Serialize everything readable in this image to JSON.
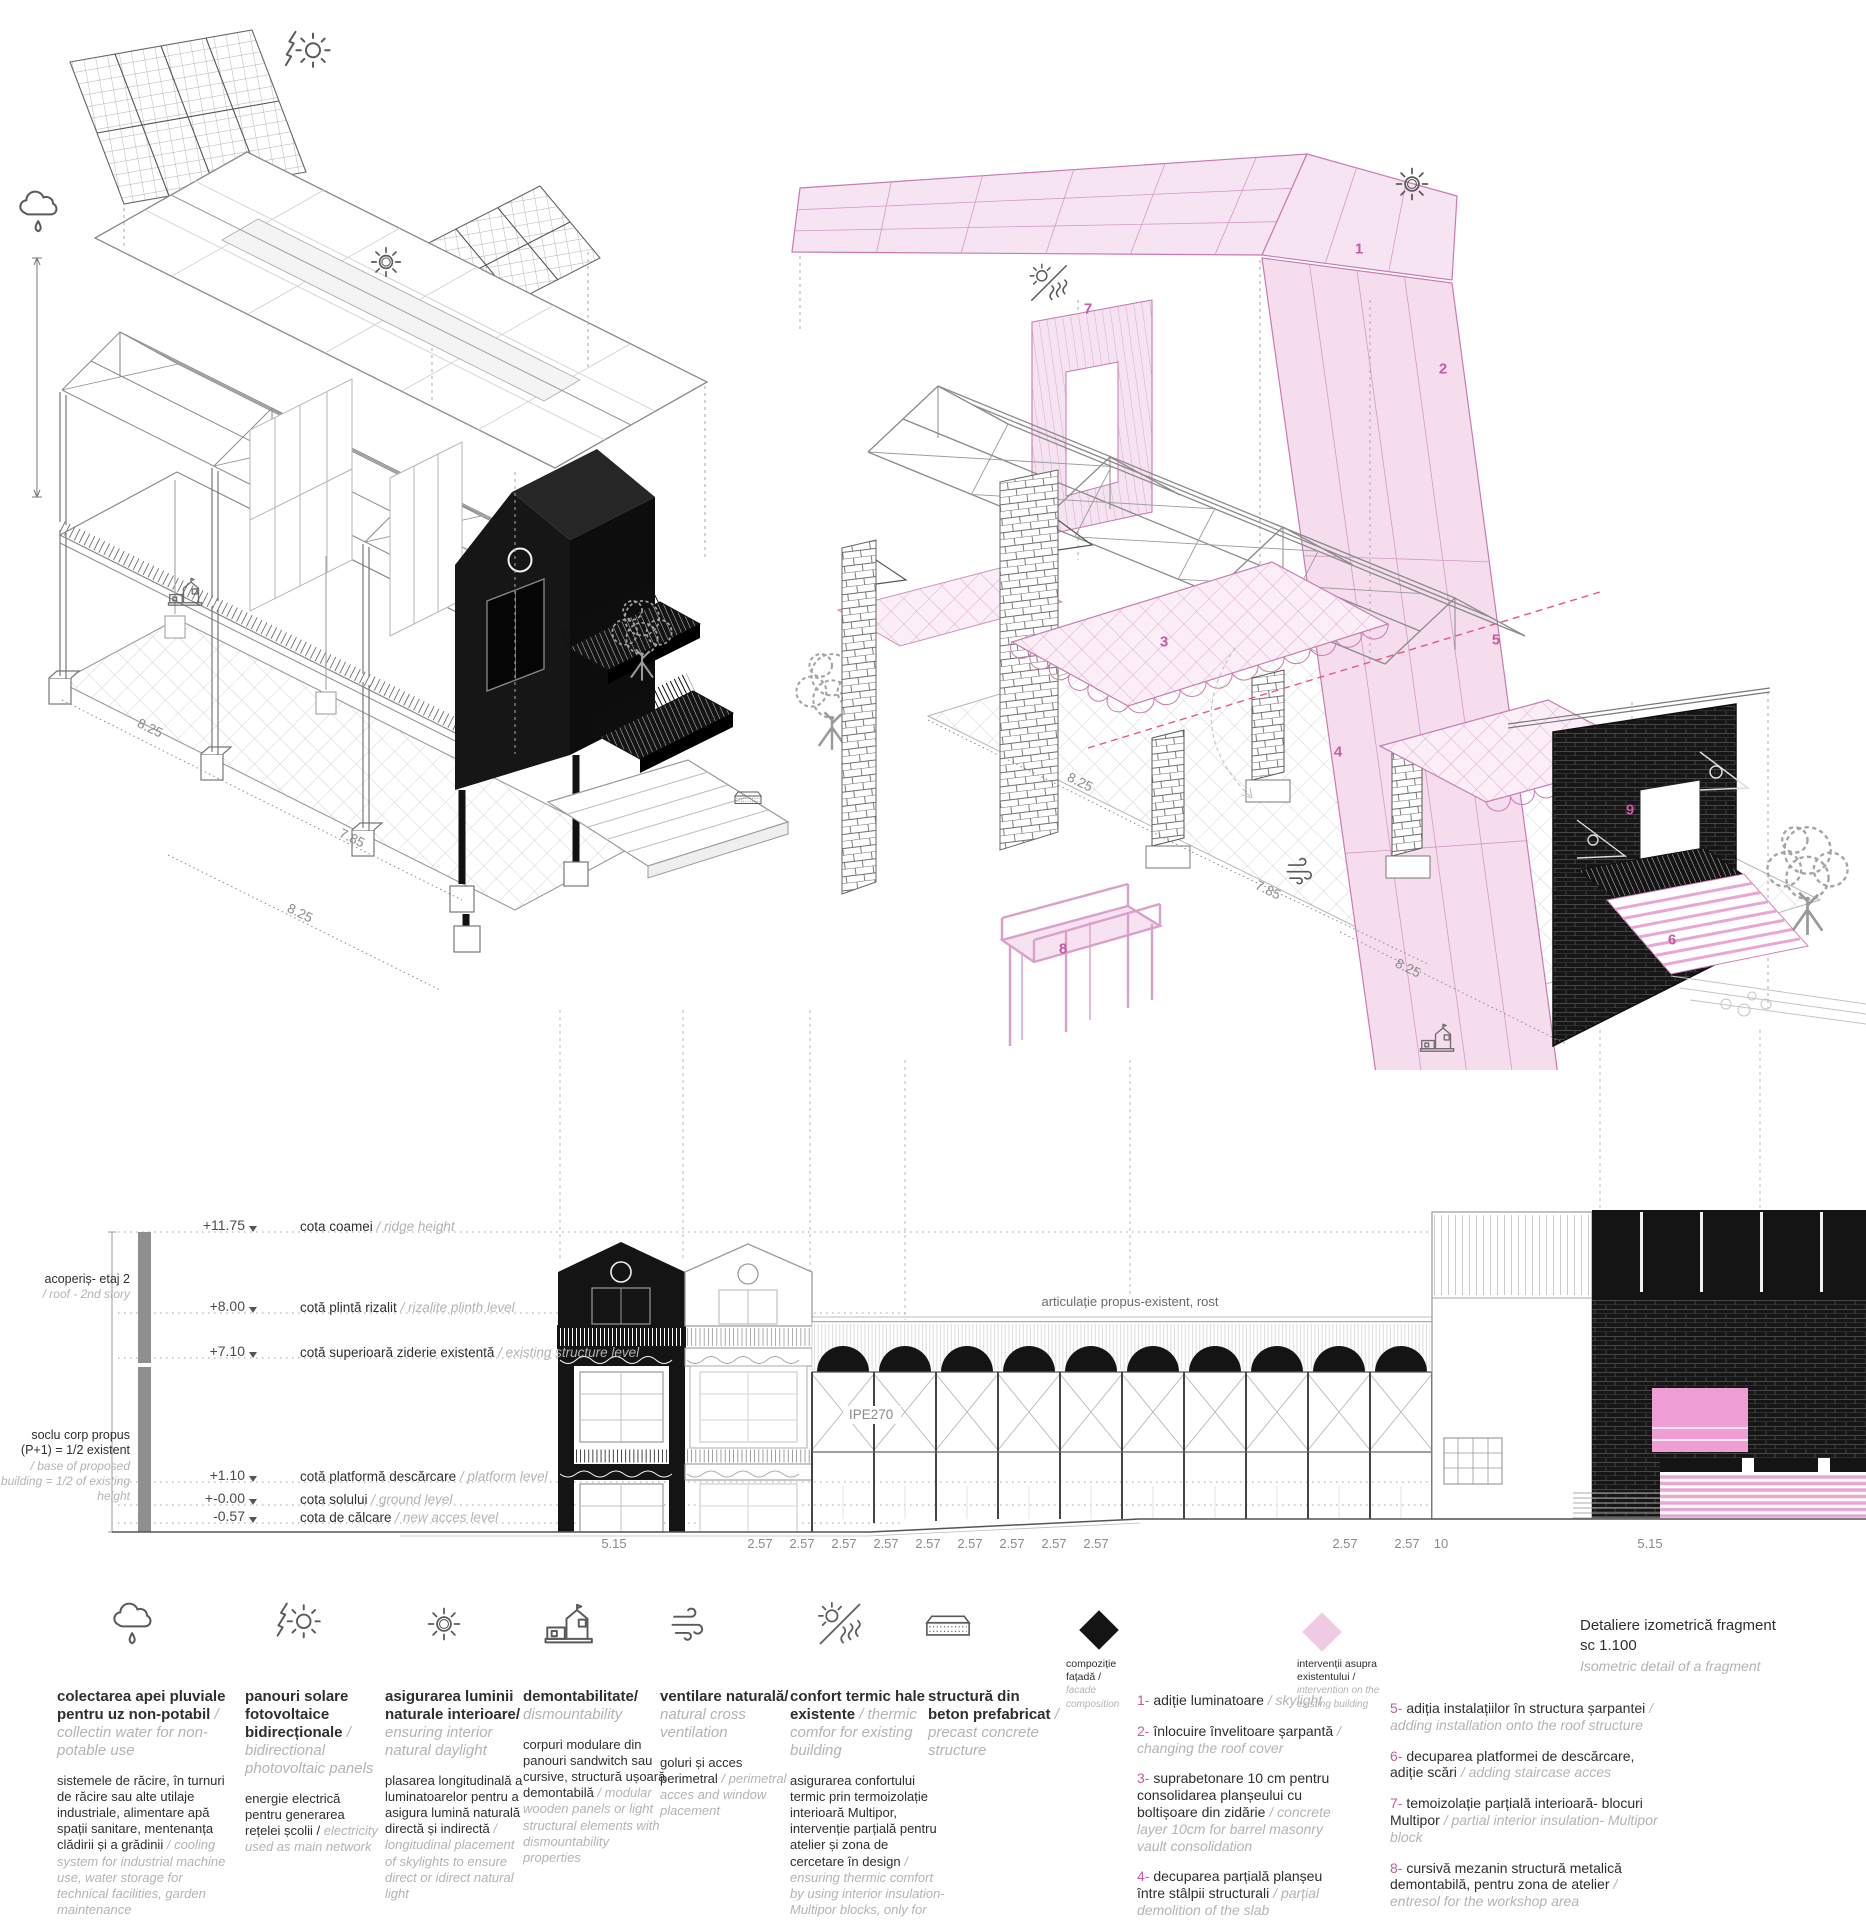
{
  "left_iso": {
    "dims": [
      "8.25",
      "7.85",
      "8.25"
    ]
  },
  "right_iso": {
    "dims": [
      "8.25",
      "7.85",
      "8.25"
    ],
    "numbers": [
      "1",
      "2",
      "3",
      "4",
      "5",
      "6",
      "7",
      "8",
      "9"
    ]
  },
  "elevation": {
    "levels": [
      {
        "value": "+11.75",
        "ro": "cota coamei",
        "en": "/ ridge height"
      },
      {
        "value": "+8.00",
        "ro": "cotă plintă rizalit",
        "en": "/ rizalite plinth level"
      },
      {
        "value": "+7.10",
        "ro": "cotă superioară ziderie existentă",
        "en": "/ existing structure level"
      },
      {
        "value": "+1.10",
        "ro": "cotă platformă descărcare",
        "en": "/ platform level"
      },
      {
        "value": "+-0.00",
        "ro": "cota solului",
        "en": "/ ground  level"
      },
      {
        "value": "-0.57",
        "ro": "cota de călcare",
        "en": "/ new acces level"
      }
    ],
    "story_labels": [
      {
        "ro": "acoperiș- etaj 2",
        "en": "/ roof - 2nd story"
      },
      {
        "ro": "soclu corp propus (P+1) = 1/2 existent",
        "en": "/ base of proposed building = 1/2 of existing height"
      }
    ],
    "joint_label": "articulație propus-existent, rost",
    "beam_label": "IPE270",
    "dims": [
      "5.15",
      "2.57",
      "2.57",
      "2.57",
      "2.57",
      "2.57",
      "2.57",
      "2.57",
      "2.57",
      "2.57",
      "2.57",
      "2.57",
      "10",
      "5.15"
    ]
  },
  "legend": {
    "items": [
      {
        "icon": "rain-cloud-icon",
        "title_ro": "colectarea apei pluviale pentru uz non-potabil",
        "title_en": "/ collectin water for non-potable use",
        "body_ro": "sistemele de răcire, în turnuri de răcire sau alte utilaje industriale, alimentare apă spații sanitare, mentenanța clădirii și a grădinii",
        "body_en": "/ cooling system for industrial machine use, water storage for technical facilities, garden maintenance"
      },
      {
        "icon": "bolt-sun-icon",
        "title_ro": "panouri solare fotovoltaice bidirecționale",
        "title_en": "/ bidirectional photovoltaic panels",
        "body_ro": "energie electrică pentru generarea rețelei școlii /",
        "body_en": "electricity used as main network"
      },
      {
        "icon": "sun-icon",
        "title_ro": "asigurarea luminii naturale interioare/",
        "title_en": "ensuring interior natural daylight",
        "body_ro": "plasarea longitudinală a luminatoarelor pentru a asigura lumină naturală directă și indirectă",
        "body_en": "/ longitudinal placement of skylights to ensure direct or idirect natural light"
      },
      {
        "icon": "house-icon",
        "title_ro": "demontabilitate/",
        "title_en": "dismountability",
        "body_ro": "corpuri modulare din panouri sandwitch sau cursive, structură ușoară demontabilă",
        "body_en": "/ modular wooden panels or light structural elements with dismountability properties"
      },
      {
        "icon": "wind-icon",
        "title_ro": "ventilare naturală/",
        "title_en": "natural cross ventilation",
        "body_ro": "goluri și acces perimetral",
        "body_en": "/ perimetral acces and window placement"
      },
      {
        "icon": "thermal-sun-icon",
        "title_ro": "confort termic hale existente",
        "title_en": "/ thermic comfor for existing building",
        "body_ro": "asigurarea confortului termic prin termoizolație interioară Multipor, intervenție parțială pentru atelier și zona de cercetare în design",
        "body_en": "/ ensuring thermic comfort by using interior insulation- Multipor blocks, only for design research and workshop area"
      },
      {
        "icon": "slab-icon",
        "title_ro": "structură din beton prefabricat",
        "title_en": "/ precast concrete structure",
        "body_ro": "",
        "body_en": ""
      }
    ],
    "diamonds": [
      {
        "name": "facade-composition",
        "color": "#141414",
        "label_ro": "compoziție fațadă /",
        "label_en": "facade composition"
      },
      {
        "name": "intervention-existing",
        "color": "#efcbe3",
        "label_ro": "intervenții asupra existentului /",
        "label_en": "intervention on the existing building"
      }
    ],
    "interventions_col1": [
      {
        "num": "1-",
        "ro": "adiție luminatoare",
        "en": "/ skylight"
      },
      {
        "num": "2-",
        "ro": "înlocuire învelitoare șarpantă",
        "en": "/ changing the roof cover"
      },
      {
        "num": "3-",
        "ro": "suprabetonare 10 cm pentru consolidarea planșeului cu boltișoare din zidărie",
        "en": "/ concrete layer 10cm for barrel masonry vault consolidation"
      },
      {
        "num": "4-",
        "ro": "decuparea parțială planșeu între stâlpii structurali",
        "en": "/ parțial demolition of the slab"
      }
    ],
    "interventions_col2": [
      {
        "num": "5-",
        "ro": "adiția instalațiilor în structura șarpantei",
        "en": "/ adding installation onto the roof structure"
      },
      {
        "num": "6-",
        "ro": "decuparea platformei de descărcare, adiție scări",
        "en": "/ adding staircase acces"
      },
      {
        "num": "7-",
        "ro": "temoizolație parțială interioară- blocuri Multipor",
        "en": "/ partial interior insulation- Multipor block"
      },
      {
        "num": "8-",
        "ro": "cursivă mezanin structură metalică demontabilă, pentru zona de atelier",
        "en": "/ entresol for the workshop area"
      },
      {
        "num": "9-",
        "ro": "buiandrug pentru schimbarea tâmplăriei",
        "en": "/ window lintel"
      }
    ],
    "title_block": {
      "line1": "Detaliere izometrică fragment",
      "line2": "sc 1.100",
      "line3": "Isometric detail of a fragment"
    }
  },
  "colors": {
    "pink_fill": "#f6e2f0",
    "pink_line": "#c77bb2",
    "pink_accent": "#c65ba3",
    "magenta_dash": "#e8558c",
    "ink": "#141414",
    "gray_line": "#9a9a9a"
  }
}
